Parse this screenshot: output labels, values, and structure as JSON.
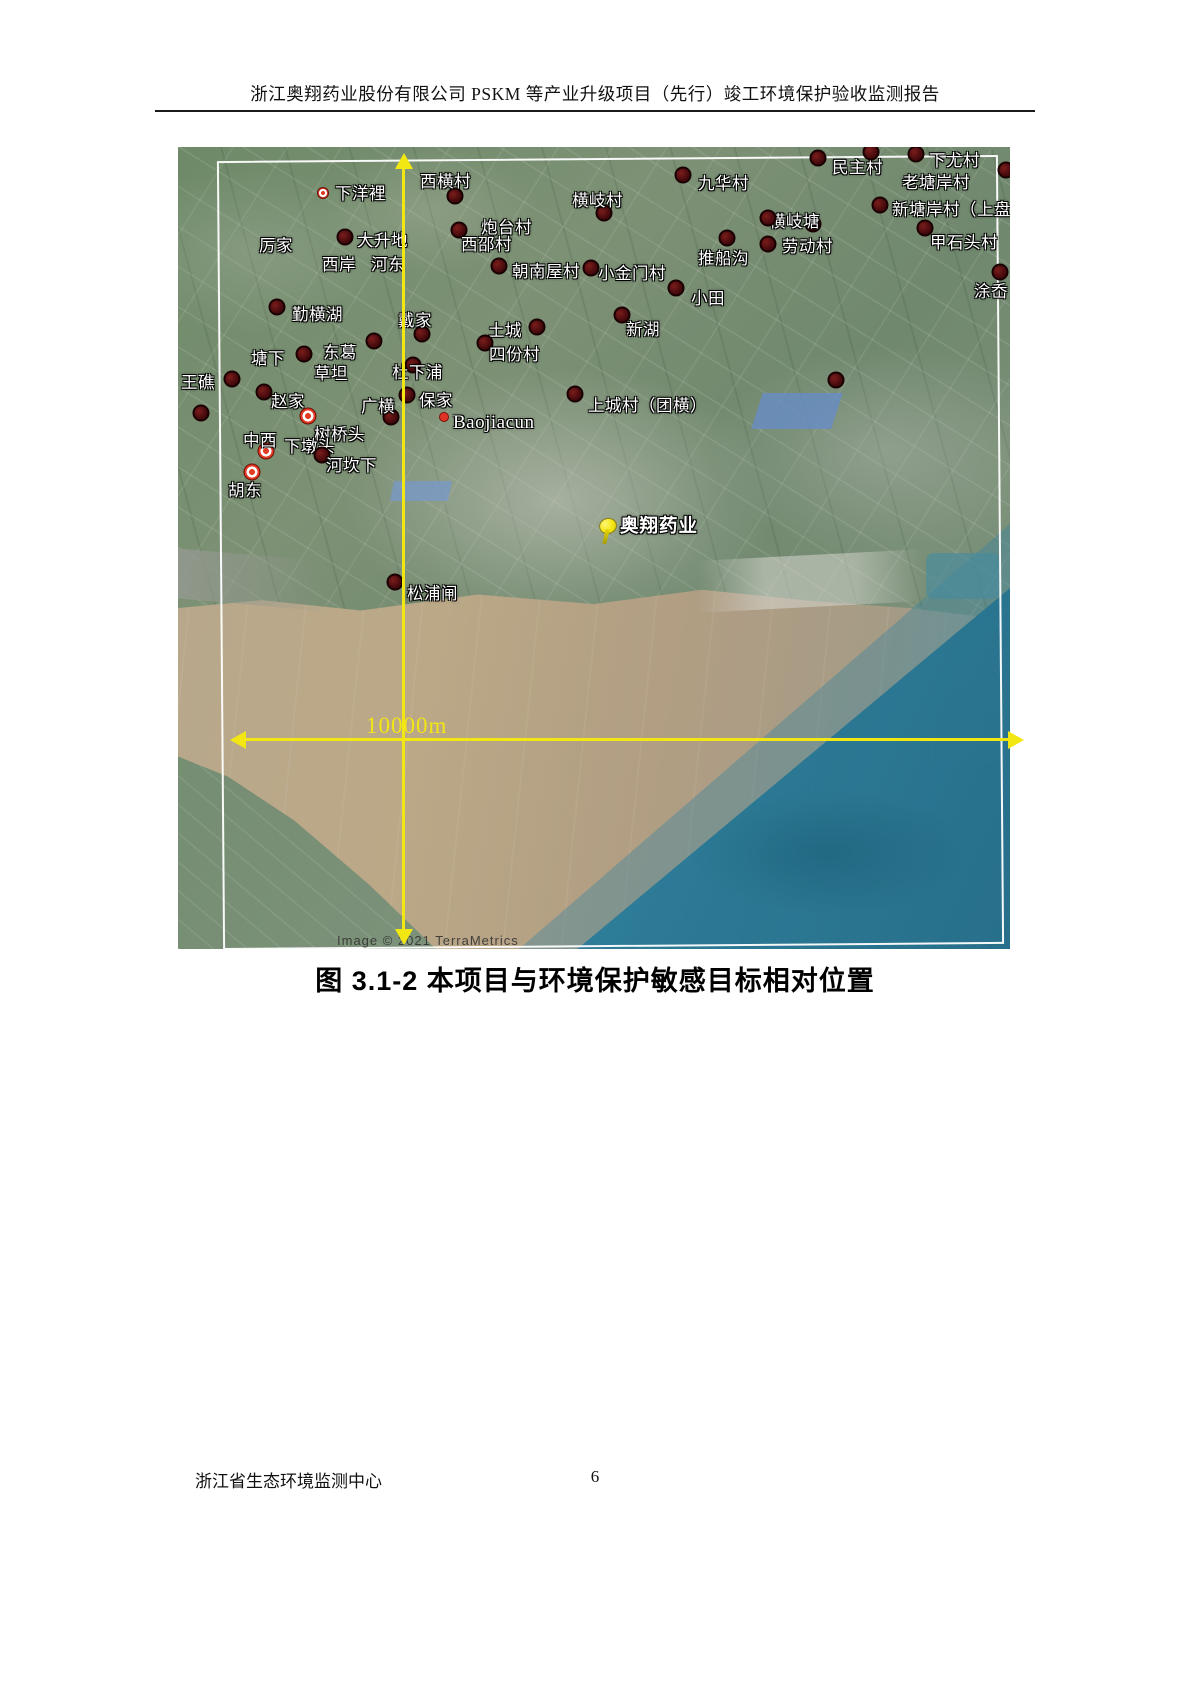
{
  "header": {
    "title": "浙江奥翔药业股份有限公司 PSKM 等产业升级项目（先行）竣工环境保护验收监测报告"
  },
  "figure": {
    "caption": "图 3.1-2  本项目与环境保护敏感目标相对位置",
    "scale_label": "10000m",
    "attribution": "Image © 2021 TerraMetrics",
    "project": {
      "label": "奥翔药业",
      "pin_x": 429,
      "pin_y": 380,
      "label_x": 442,
      "label_y": 378
    },
    "colors": {
      "line_yellow": "#f2e712",
      "marker_dark": "#4c0c0e",
      "marker_ring_red": "#e23c26",
      "frame_white": "#ffffff",
      "river_brown": "#b4a287",
      "sea_teal": "#2b7f9e",
      "land_green": "#75906f"
    },
    "places": [
      {
        "label": "下洋裡",
        "marker": "ring-sm",
        "mx": 145,
        "my": 46,
        "tx": 157,
        "ty": 45
      },
      {
        "label": "西横村",
        "marker": "dark",
        "mx": 277,
        "my": 49,
        "tx": 242,
        "ty": 33
      },
      {
        "label": "厉家",
        "marker": "none",
        "tx": 81,
        "ty": 97
      },
      {
        "label": "大升地",
        "marker": "dark",
        "mx": 167,
        "my": 90,
        "tx": 179,
        "ty": 92
      },
      {
        "label": "西岸",
        "marker": "none",
        "tx": 144,
        "ty": 116
      },
      {
        "label": "河东",
        "marker": "none",
        "tx": 193,
        "ty": 116
      },
      {
        "label": "炮台村",
        "marker": "dark",
        "mx": 281,
        "my": 83,
        "tx": 303,
        "ty": 79
      },
      {
        "label": "西邵村",
        "marker": "none",
        "tx": 283,
        "ty": 96
      },
      {
        "label": "横岐村",
        "marker": "dark",
        "mx": 426,
        "my": 66,
        "tx": 394,
        "ty": 52
      },
      {
        "label": "九华村",
        "marker": "dark",
        "mx": 505,
        "my": 28,
        "tx": 520,
        "ty": 35
      },
      {
        "label": "民主村",
        "marker": "dark",
        "mx": 640,
        "my": 11,
        "tx": 654,
        "ty": 19
      },
      {
        "label": "下尤村",
        "marker": "dark",
        "mx": 738,
        "my": 7,
        "tx": 751,
        "ty": 12
      },
      {
        "label": "老塘岸村",
        "marker": "none",
        "tx": 724,
        "ty": 34
      },
      {
        "label": "新塘岸村（上盘",
        "marker": "dark",
        "mx": 702,
        "my": 58,
        "tx": 714,
        "ty": 61
      },
      {
        "label": "甲石头村",
        "marker": "dark",
        "mx": 747,
        "my": 81,
        "tx": 752,
        "ty": 94
      },
      {
        "label": "涂岙",
        "marker": "dark",
        "mx": 822,
        "my": 125,
        "tx": 796,
        "ty": 143
      },
      {
        "label": "横岐塘",
        "marker": "dark",
        "mx": 635,
        "my": 77,
        "tx": 591,
        "ty": 73
      },
      {
        "label": "",
        "marker": "dark",
        "mx": 590,
        "my": 71
      },
      {
        "label": "劳动村",
        "marker": "dark",
        "mx": 590,
        "my": 97,
        "tx": 604,
        "ty": 98
      },
      {
        "label": "推船沟",
        "marker": "dark",
        "mx": 549,
        "my": 91,
        "tx": 520,
        "ty": 110
      },
      {
        "label": "小金门村",
        "marker": "dark",
        "mx": 413,
        "my": 121,
        "tx": 420,
        "ty": 125
      },
      {
        "label": "朝南屋村",
        "marker": "dark",
        "mx": 321,
        "my": 119,
        "tx": 334,
        "ty": 123
      },
      {
        "label": "小田",
        "marker": "dark",
        "mx": 498,
        "my": 141,
        "tx": 513,
        "ty": 150
      },
      {
        "label": "新湖",
        "marker": "dark",
        "mx": 444,
        "my": 168,
        "tx": 448,
        "ty": 181
      },
      {
        "label": "土城",
        "marker": "dark",
        "mx": 359,
        "my": 180,
        "tx": 310,
        "ty": 182
      },
      {
        "label": "四份村",
        "marker": "dark",
        "mx": 307,
        "my": 196,
        "tx": 311,
        "ty": 206
      },
      {
        "label": "勤横湖",
        "marker": "dark",
        "mx": 99,
        "my": 160,
        "tx": 114,
        "ty": 166
      },
      {
        "label": "戴家",
        "marker": "dark",
        "mx": 244,
        "my": 187,
        "tx": 220,
        "ty": 172
      },
      {
        "label": "塘下",
        "marker": "dark",
        "mx": 126,
        "my": 207,
        "tx": 73,
        "ty": 210
      },
      {
        "label": "东葛",
        "marker": "dark",
        "mx": 196,
        "my": 194,
        "tx": 145,
        "ty": 204
      },
      {
        "label": "草坦",
        "marker": "none",
        "tx": 136,
        "ty": 225
      },
      {
        "label": "杜下浦",
        "marker": "dark",
        "mx": 235,
        "my": 218,
        "tx": 214,
        "ty": 224
      },
      {
        "label": "王礁",
        "marker": "dark",
        "mx": 54,
        "my": 232,
        "tx": 3,
        "ty": 234
      },
      {
        "label": "赵家",
        "marker": "dark",
        "mx": 86,
        "my": 245,
        "tx": 93,
        "ty": 253
      },
      {
        "label": "广横",
        "marker": "dark",
        "mx": 213,
        "my": 270,
        "tx": 183,
        "ty": 258
      },
      {
        "label": "保家",
        "marker": "dark",
        "mx": 229,
        "my": 248,
        "tx": 241,
        "ty": 252
      },
      {
        "label": "Baojiacun",
        "marker": "pin",
        "latin": true,
        "mx": 266,
        "my": 270,
        "tx": 275,
        "ty": 276
      },
      {
        "label": "树桥头",
        "marker": "ring",
        "mx": 130,
        "my": 269,
        "tx": 136,
        "ty": 286
      },
      {
        "label": "中西",
        "marker": "ring",
        "mx": 88,
        "my": 304,
        "tx": 65,
        "ty": 292
      },
      {
        "label": "下墩头",
        "marker": "none",
        "tx": 106,
        "ty": 298
      },
      {
        "label": "河坎下",
        "marker": "dark",
        "mx": 144,
        "my": 308,
        "tx": 148,
        "ty": 317
      },
      {
        "label": "胡东",
        "marker": "ring",
        "mx": 74,
        "my": 325,
        "tx": 50,
        "ty": 342
      },
      {
        "label": "上城村（团横）",
        "marker": "dark",
        "mx": 397,
        "my": 247,
        "tx": 410,
        "ty": 257
      },
      {
        "label": "松浦闸",
        "marker": "dark",
        "mx": 217,
        "my": 435,
        "tx": 229,
        "ty": 445
      },
      {
        "label": "",
        "marker": "dark",
        "mx": 693,
        "my": 5
      },
      {
        "label": "",
        "marker": "dark",
        "mx": 828,
        "my": 23
      },
      {
        "label": "",
        "marker": "dark",
        "mx": 23,
        "my": 266
      },
      {
        "label": "",
        "marker": "dark",
        "mx": 658,
        "my": 233
      }
    ]
  },
  "footer": {
    "org": "浙江省生态环境监测中心",
    "page": "6"
  }
}
